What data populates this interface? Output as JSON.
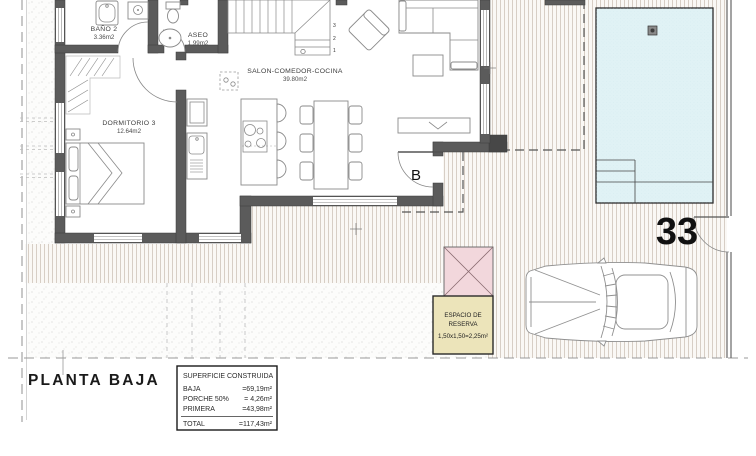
{
  "plan": {
    "title": "PLANTA BAJA"
  },
  "plot": {
    "number": "33"
  },
  "door": {
    "label": "B"
  },
  "rooms": {
    "bano2": {
      "name": "BAÑO 2",
      "area": "3.36m2"
    },
    "aseo": {
      "name": "ASEO",
      "area": "1.99m2"
    },
    "dormitorio3": {
      "name": "DORMITORIO 3",
      "area": "12.64m2"
    },
    "salon": {
      "name": "SALON-COMEDOR-COCINA",
      "area": "39.80m2"
    }
  },
  "stairs": {
    "n1": "1",
    "n2": "2",
    "n3": "3"
  },
  "reserve": {
    "line1": "ESPACIO DE",
    "line2": "RESERVA",
    "line3": "1,50x1,50=2,25m²"
  },
  "areas_table": {
    "title": "SUPERFICIE CONSTRUIDA",
    "rows": [
      {
        "label": "BAJA",
        "value": "=69,19m²"
      },
      {
        "label": "PORCHE 50%",
        "value": "= 4,26m²"
      },
      {
        "label": "PRIMERA",
        "value": "=43,98m²"
      }
    ],
    "total": {
      "label": "TOTAL",
      "value": "=117,43m²"
    }
  },
  "colors": {
    "pool": "#e0f2f5",
    "roof": "#f2d7dc",
    "reserve": "#ece4ba",
    "wall": "#5b5b5b"
  }
}
